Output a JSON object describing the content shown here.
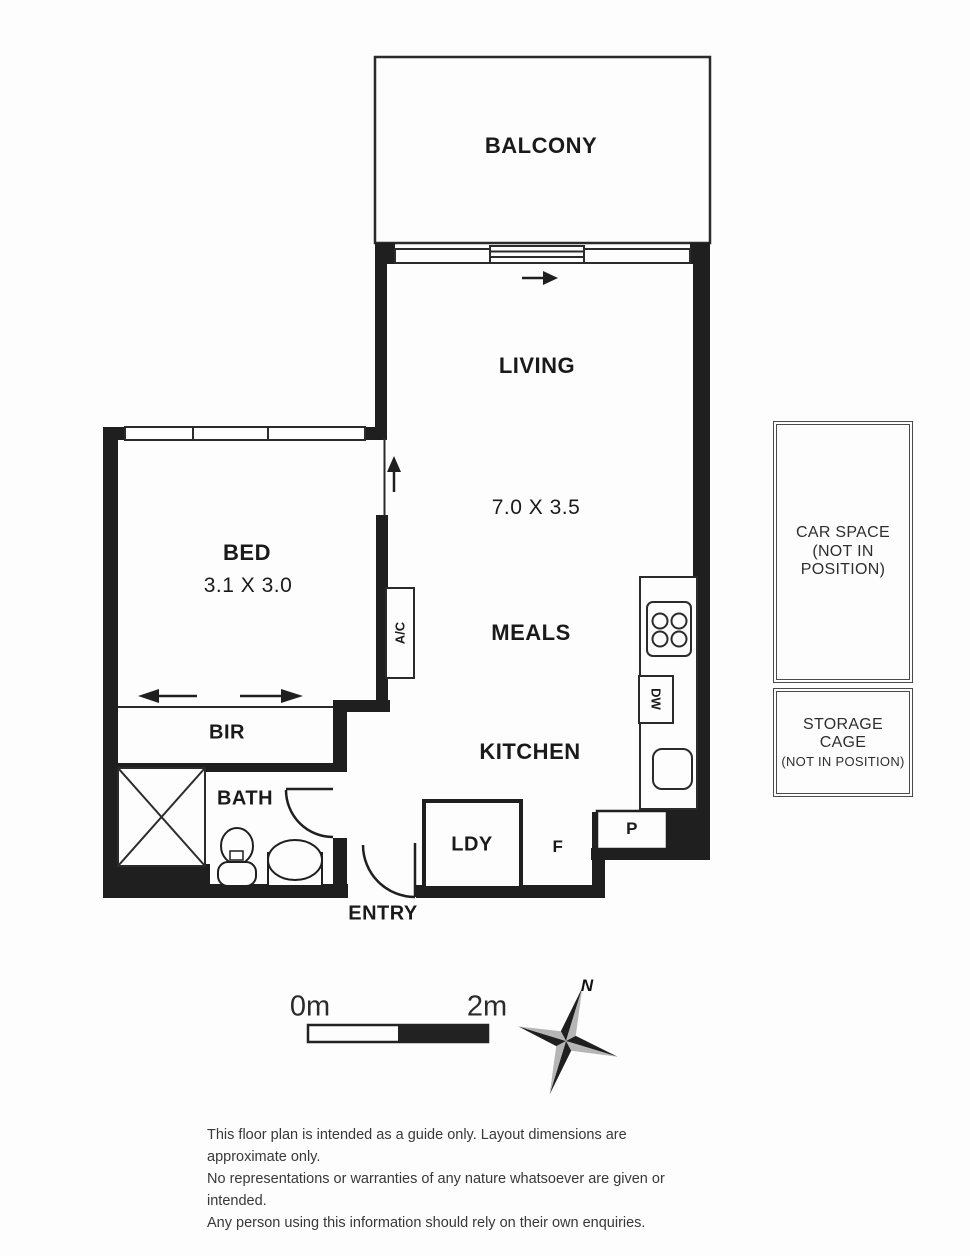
{
  "floorplan": {
    "rooms": {
      "balcony": {
        "label": "BALCONY"
      },
      "living": {
        "label": "LIVING",
        "dimensions": "7.0 X 3.5"
      },
      "bed": {
        "label": "BED",
        "dimensions": "3.1 X 3.0"
      },
      "meals": {
        "label": "MEALS"
      },
      "kitchen": {
        "label": "KITCHEN"
      },
      "bir": {
        "label": "BIR"
      },
      "bath": {
        "label": "BATH"
      },
      "entry": {
        "label": "ENTRY"
      },
      "laundry": {
        "label": "LDY"
      },
      "fridge": {
        "label": "F"
      },
      "pantry": {
        "label": "P"
      },
      "aircon": {
        "label": "A/C"
      },
      "dishwasher": {
        "label": "DW"
      }
    },
    "legend": {
      "car_space": {
        "line1": "CAR SPACE",
        "line2": "(NOT IN",
        "line3": "POSITION)"
      },
      "storage_cage": {
        "line1": "STORAGE",
        "line2": "CAGE",
        "line3": "(NOT IN POSITION)"
      }
    },
    "scale_bar": {
      "start_label": "0m",
      "end_label": "2m"
    },
    "compass": {
      "north_label": "N"
    },
    "disclaimer": {
      "line1": "This floor plan is intended as a guide only. Layout dimensions are approximate only.",
      "line2": "No representations or warranties of any nature whatsoever are given or intended.",
      "line3": "Any person using this information should rely on their own enquiries."
    },
    "colors": {
      "wall": "#1f1f1f",
      "line": "#2b2b2b",
      "text": "#1a1a1a",
      "compass_gray": "#b5b5b5",
      "disclaimer_text": "#383838"
    }
  }
}
